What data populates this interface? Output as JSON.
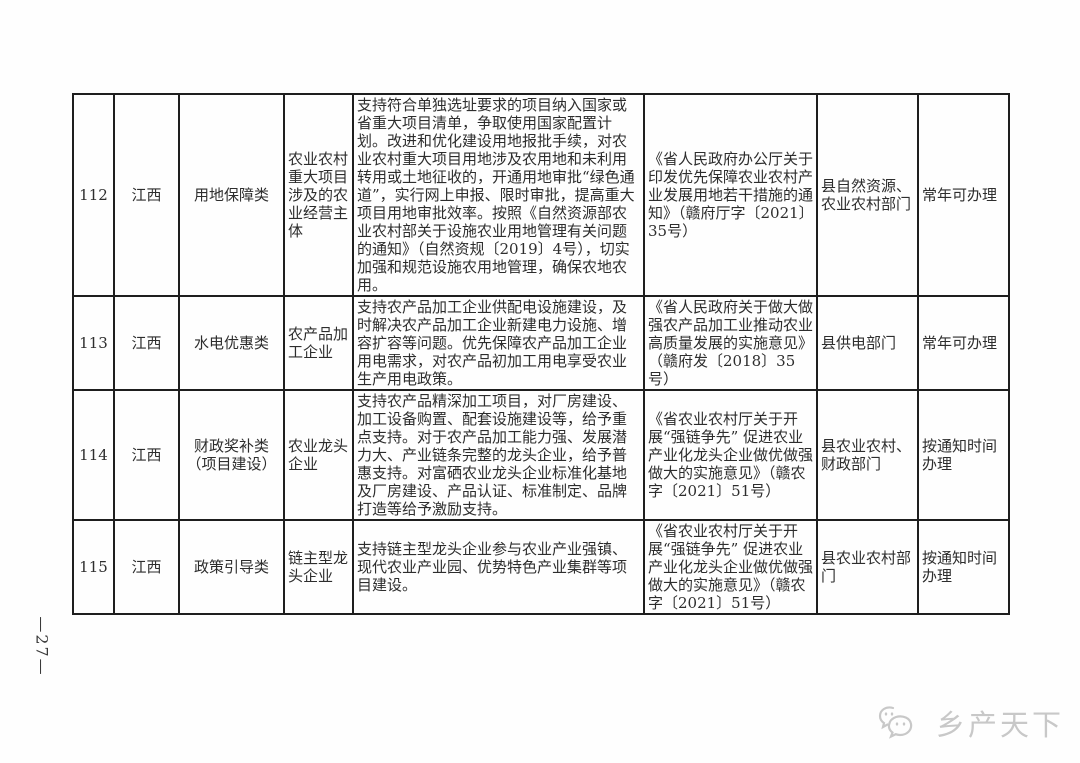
{
  "page": {
    "number_label": "—27—",
    "watermark_label": "乡产天下",
    "watermark_icon": "chat-bubbles-icon"
  },
  "colors": {
    "table_border": "#1e1e1e",
    "body_text": "#2d2d2d",
    "watermark": "#c8c8c8"
  },
  "table": {
    "rows": [
      {
        "no": "112",
        "province": "江西",
        "category": "用地保障类",
        "target": "农业农村重大项目涉及的农业经营主体",
        "content": "支持符合单独选址要求的项目纳入国家或省重大项目清单，争取使用国家配置计划。改进和优化建设用地报批手续，对农业农村重大项目用地涉及农用地和未利用转用或土地征收的，开通用地审批“绿色通道”，实行网上申报、限时审批，提高重大项目用地审批效率。按照《自然资源部农业农村部关于设施农业用地管理有关问题的通知》（自然资规〔2019〕4号），切实加强和规范设施农用地管理，确保农地农用。",
        "basis": "《省人民政府办公厅关于印发优先保障农业农村产业发展用地若干措施的通知》（赣府厅字〔2021〕35号）",
        "department": "县自然资源、农业农村部门",
        "timing": "常年可办理"
      },
      {
        "no": "113",
        "province": "江西",
        "category": "水电优惠类",
        "target": "农产品加工企业",
        "content": "支持农产品加工企业供配电设施建设，及时解决农产品加工企业新建电力设施、增容扩容等问题。优先保障农产品加工企业用电需求，对农产品初加工用电享受农业生产用电政策。",
        "basis": "《省人民政府关于做大做强农产品加工业推动农业高质量发展的实施意见》（赣府发〔2018〕35号）",
        "department": "县供电部门",
        "timing": "常年可办理"
      },
      {
        "no": "114",
        "province": "江西",
        "category": "财政奖补类（项目建设）",
        "target": "农业龙头企业",
        "content": "支持农产品精深加工项目，对厂房建设、加工设备购置、配套设施建设等，给予重点支持。对于农产品加工能力强、发展潜力大、产业链条完整的龙头企业，给予普惠支持。对富硒农业龙头企业标准化基地及厂房建设、产品认证、标准制定、品牌打造等给予激励支持。",
        "basis": "《省农业农村厅关于开展“强链争先” 促进农业产业化龙头企业做优做强做大的实施意见》（赣农字〔2021〕51号）",
        "department": "县农业农村、财政部门",
        "timing": "按通知时间办理"
      },
      {
        "no": "115",
        "province": "江西",
        "category": "政策引导类",
        "target": "链主型龙头企业",
        "content": "支持链主型龙头企业参与农业产业强镇、现代农业产业园、优势特色产业集群等项目建设。",
        "basis": "《省农业农村厅关于开展“强链争先” 促进农业产业化龙头企业做优做强做大的实施意见》（赣农字〔2021〕51号）",
        "department": "县农业农村部门",
        "timing": "按通知时间办理"
      }
    ]
  }
}
